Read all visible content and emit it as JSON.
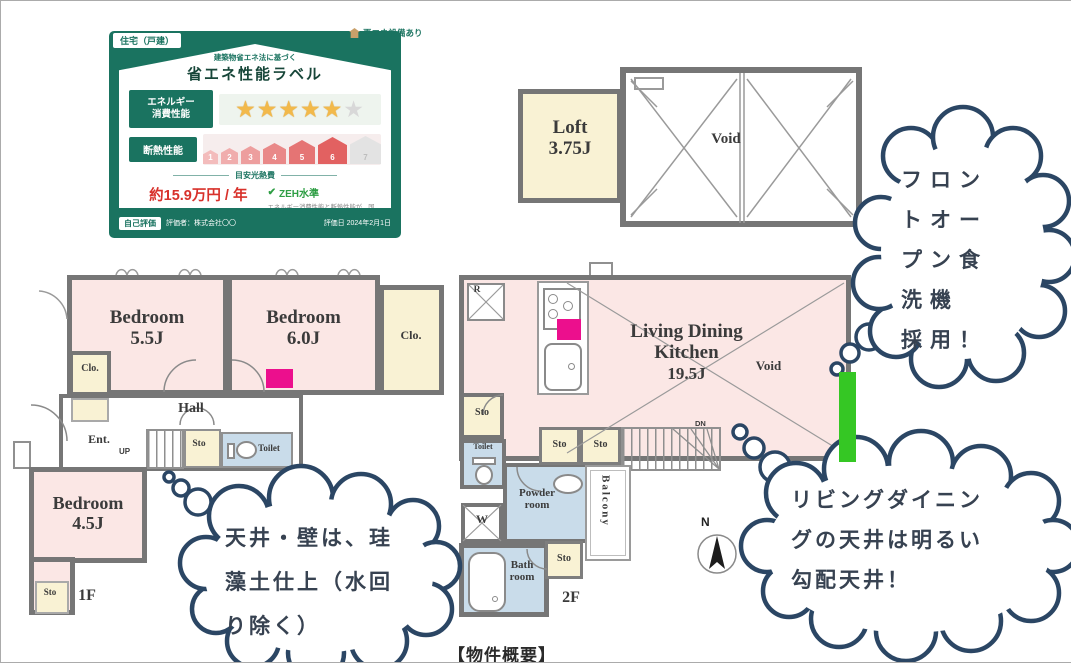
{
  "colors": {
    "accent_magenta": "#ec0f8d",
    "accent_green": "#35c724",
    "card_green": "#1a7360",
    "cloud_navy": "#2b4664"
  },
  "energy_label": {
    "tab": "住宅（戸建）",
    "renewable_note": "再エネ設備あり",
    "subtitle": "建築物省エネ法に基づく",
    "title": "省エネ性能ラベル",
    "energy_row_label_1": "エネルギー",
    "energy_row_label_2": "消費性能",
    "stars_filled": "★★★★★",
    "star_empty": "★",
    "insulation_label": "断熱性能",
    "scale": [
      "1",
      "2",
      "3",
      "4",
      "5",
      "6",
      "7"
    ],
    "cost_heading": "目安光熱費",
    "cost_amount": "約15.9万円 / 年",
    "zeh_check": "✔",
    "zeh_label": "ZEH水準",
    "zeh_note": "エネルギー消費性能と断熱性能が、国の定める水準を満たす場合に表示されます。",
    "cost_note": "この光熱費は、めやすの値です。電気・ガス・灯油の使用量をもとに、全国統一の燃料等単価を用いて機械的に算出した値であり、実際の光熱費とは異なります。",
    "self_eval": "自己評価",
    "evaluator": "評価者：株式会社〇〇",
    "eval_date": "評価日 2024年2月1日"
  },
  "floor_plan": {
    "loft_name": "Loft",
    "loft_size": "3.75J",
    "void_label": "Void",
    "bed1_name": "Bedroom",
    "bed1_size": "5.5J",
    "bed2_name": "Bedroom",
    "bed2_size": "6.0J",
    "bed3_name": "Bedroom",
    "bed3_size": "4.5J",
    "clo_label": "Clo.",
    "hall": "Hall",
    "ent": "Ent.",
    "up": "UP",
    "dn": "DN",
    "sto_label": "Sto",
    "toilet_label": "Toilet",
    "fridge": "R",
    "ldk_line1": "Living Dining",
    "ldk_line2": "Kitchen",
    "ldk_size": "19.5J",
    "powder_1": "Powder",
    "powder_2": "room",
    "washer": "W",
    "bath_1": "Bath",
    "bath_2": "room",
    "balcony": "Balcony",
    "floor1": "1F",
    "floor2": "2F",
    "north": "N"
  },
  "callouts": {
    "dishwasher_l1": "フロン",
    "dishwasher_l2": "トオー",
    "dishwasher_l3": "プン食",
    "dishwasher_l4": "洗機",
    "dishwasher_l5": "採用！",
    "ceiling_l1": "リビングダイニン",
    "ceiling_l2": "グの天井は明るい",
    "ceiling_l3": "勾配天井！",
    "wall_l1": "天井・壁は、珪",
    "wall_l2": "藻土仕上（水回",
    "wall_l3": "り除く）"
  },
  "caption": "【物件概要】"
}
